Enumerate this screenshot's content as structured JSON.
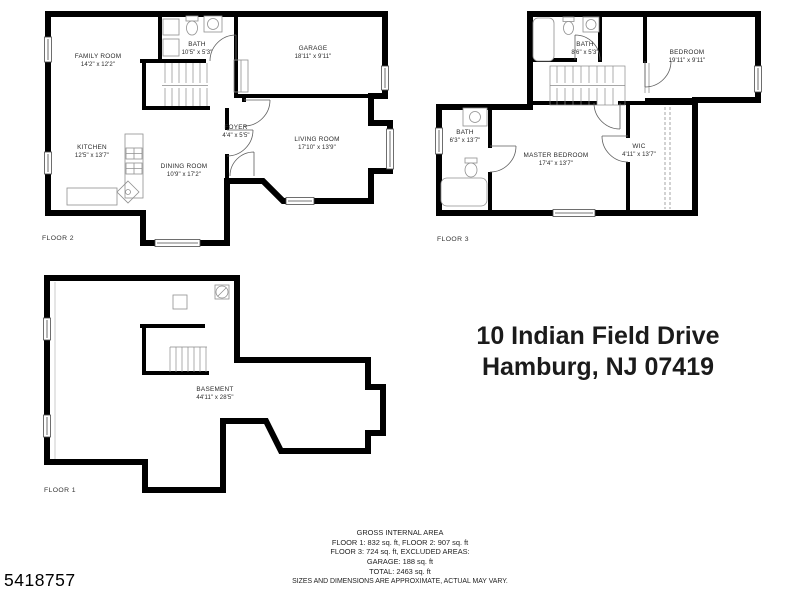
{
  "listing_id": "5418757",
  "address": {
    "line1": "10 Indian Field Drive",
    "line2": "Hamburg, NJ 07419"
  },
  "floors": [
    {
      "label": "FLOOR 2",
      "rooms": [
        {
          "name": "FAMILY ROOM",
          "dims": "14'2\" x 12'2\""
        },
        {
          "name": "BATH",
          "dims": "10'5\" x 5'3\""
        },
        {
          "name": "GARAGE",
          "dims": "18'11\" x 9'11\""
        },
        {
          "name": "KITCHEN",
          "dims": "12'5\" x 13'7\""
        },
        {
          "name": "DINING ROOM",
          "dims": "10'9\" x 17'2\""
        },
        {
          "name": "FOYER",
          "dims": "4'4\" x 5'5\""
        },
        {
          "name": "LIVING ROOM",
          "dims": "17'10\" x 13'9\""
        }
      ]
    },
    {
      "label": "FLOOR 3",
      "rooms": [
        {
          "name": "BATH",
          "dims": "8'6\" x 5'3\""
        },
        {
          "name": "BEDROOM",
          "dims": "19'11\" x 9'11\""
        },
        {
          "name": "BATH",
          "dims": "6'3\" x 13'7\""
        },
        {
          "name": "MASTER BEDROOM",
          "dims": "17'4\" x 13'7\""
        },
        {
          "name": "WIC",
          "dims": "4'11\" x 13'7\""
        }
      ]
    },
    {
      "label": "FLOOR 1",
      "rooms": [
        {
          "name": "BASEMENT",
          "dims": "44'11\" x 28'5\""
        }
      ]
    }
  ],
  "area_summary": {
    "title": "GROSS INTERNAL AREA",
    "lines": [
      "FLOOR 1: 832 sq. ft, FLOOR 2: 907 sq. ft",
      "FLOOR 3: 724 sq. ft, EXCLUDED AREAS:",
      "GARAGE: 188 sq. ft",
      "TOTAL: 2463 sq. ft"
    ],
    "disclaimer": "SIZES AND DIMENSIONS ARE APPROXIMATE, ACTUAL MAY VARY."
  },
  "colors": {
    "wall": "#000000",
    "fixture": "#909090",
    "text": "#1b1b1b"
  }
}
